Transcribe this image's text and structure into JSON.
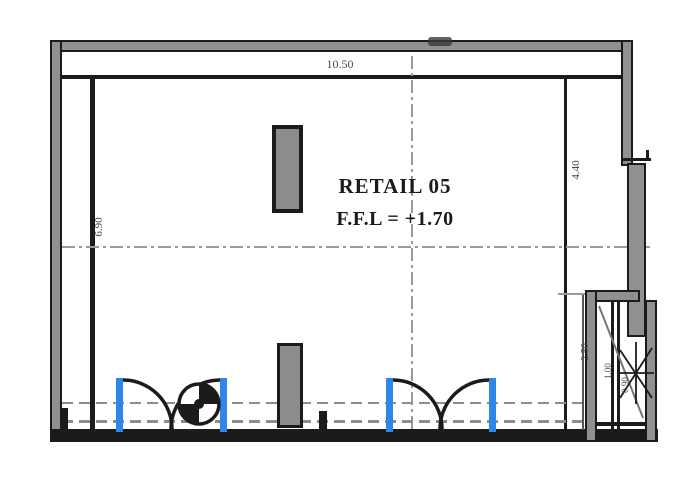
{
  "drawing": {
    "room_label": "RETAIL 05",
    "ffl_label": "F.F.L = +1.70"
  },
  "dimensions": {
    "top_width": "10.50",
    "left_height": "6.90",
    "right_upper": "4.40",
    "right_lower": "2.50",
    "shaft_width": "1.00",
    "shaft_depth": "0.90"
  },
  "colors": {
    "bg": "#ffffff",
    "wall_gray": "#909090",
    "line_black": "#1b1b1b",
    "centerline_gray": "#9a9a9a",
    "dashed_gray": "#8d8d8d",
    "door_blue": "#2e86e8",
    "column_fill": "#8c8c8c",
    "dim_text": "#4a4a4a"
  }
}
